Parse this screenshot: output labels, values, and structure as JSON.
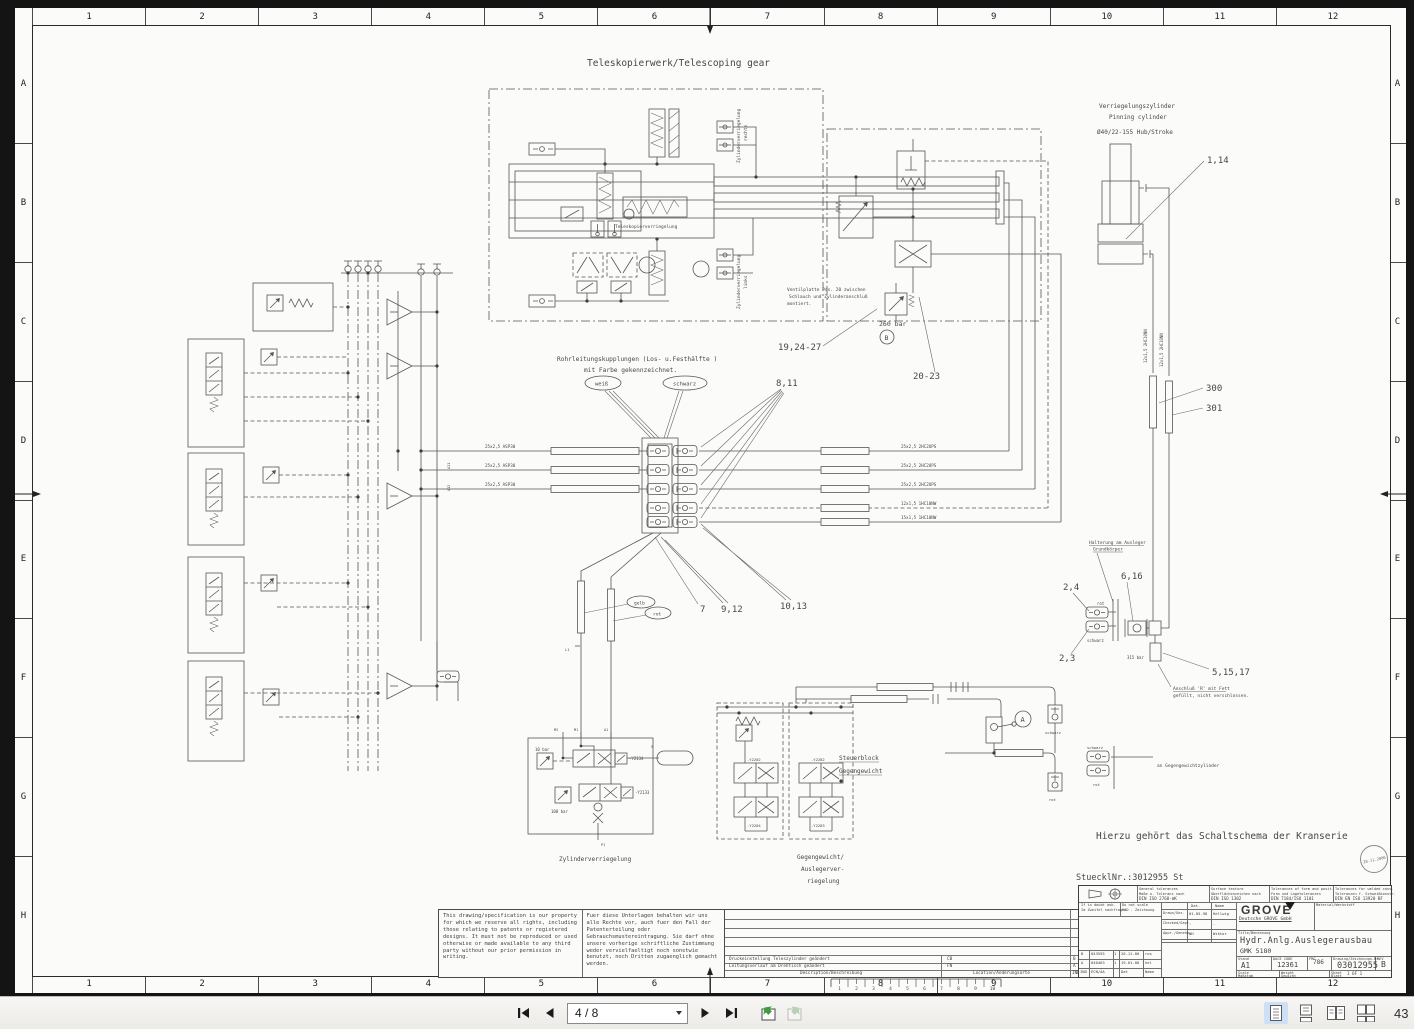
{
  "viewer": {
    "toolbar": {
      "page_field": "4 / 8",
      "zoom_value": "43",
      "icon_names": [
        "first-page",
        "previous-page",
        "next-page",
        "last-page",
        "previous-view",
        "next-view",
        "single-page-layout",
        "continuous-layout",
        "facing-layout",
        "facing-continuous-layout"
      ]
    },
    "rulers": {
      "cols": [
        "1",
        "2",
        "3",
        "4",
        "5",
        "6",
        "7",
        "8",
        "9",
        "10",
        "11",
        "12"
      ],
      "rows": [
        "A",
        "B",
        "C",
        "D",
        "E",
        "F",
        "G",
        "H"
      ]
    }
  },
  "drawing": {
    "title": "Teleskopierwerk/Telescoping gear",
    "pinning_l1": "Verriegelungszylinder",
    "pinning_l2": "Pinning cylinder",
    "pinning_l3": "Ø40/22-155 Hub/Stroke",
    "callout_1_14": "1,14",
    "ventilplatte_l1": "Ventilplatte Pos. 20 zwischen",
    "ventilplatte_l2": "Schlauch und Zylinderanschluß",
    "ventilplatte_l3": "montiert.",
    "bar_260": "260 bar",
    "stamp_b": "B",
    "stamp_a": "A",
    "callout_19_24_27": "19,24-27",
    "callout_20_23": "20-23",
    "rohr_l1": "Rohrleitungskupplungen (Los- u.Festhälfte )",
    "rohr_l2": "mit Farbe gekennzeichnet.",
    "tag_weiss": "weiß",
    "tag_schwarz": "schwarz",
    "tag_gelb": "gelb",
    "tag_rot": "rot",
    "callout_8_11": "8,11",
    "callout_7": "7",
    "callout_9_12": "9,12",
    "callout_10_13": "10,13",
    "callout_300": "300",
    "callout_301": "301",
    "callout_2_4": "2,4",
    "callout_2_3": "2,3",
    "callout_6_16": "6,16",
    "callout_5_15_17": "5,15,17",
    "pipe_asp30": "25x2,5 ASP30",
    "pipe_2hc2ops": "25x2,5 2HC2OPS",
    "pipe_12_1hc10nw": "12x1,5 1HC10NW",
    "pipe_15_1hc10nw": "15x1,5 1HC10NW",
    "pipe_2hc10nn": "12x1,5 2HC10NN",
    "halterung_l1": "Halterung am Ausleger",
    "halterung_l2": "Grundkörper",
    "bar_315": "315 bar",
    "anschluss_l1": "Anschluß 'R' mit Fett",
    "anschluss_l2": "gefüllt, nicht verschlossen.",
    "steuerblock_l1": "Steuerblock",
    "steuerblock_l2": "Gegengewicht",
    "gg_zyl": "an Gegengewichtzylinder",
    "zyl_verriegelung": "Zylinderverriegelung",
    "zyl_rechts": "rechts",
    "zyl_links": "links",
    "telesk_verr": "Teleskopierverriegelung",
    "gg_l1": "Gegengewicht/",
    "gg_l2": "Auslegerver-",
    "gg_l3": "riegelung",
    "hierzu": "Hierzu gehört das Schaltschema der Kranserie",
    "stueckliste": "StuecklNr.:3012955 St",
    "bar_10": "10 bar",
    "bar_100": "100 bar",
    "y2134": "-Y2134",
    "y2133": "-Y2133",
    "y2202": "-Y2202",
    "y2204": "-Y2204",
    "y2282": "-Y2282",
    "y2283": "-Y2283",
    "port_m2": "M2",
    "port_m1": "M1",
    "port_a1": "A1",
    "port_p1": "P1",
    "port_s": "S",
    "port_l1": "L1",
    "port_a11": "A11",
    "port_a12": "A12",
    "scale_ruler": [
      "1",
      "2",
      "3",
      "4",
      "5",
      "6",
      "7",
      "8",
      "9",
      "10"
    ]
  },
  "title_block": {
    "stamp_date": "28.11.2000",
    "general_en": "General tolerances",
    "general_de": "Maße o. Toleranz nach",
    "general_din": "DIN ISO 2768-mK",
    "surface_en": "Surface texture",
    "surface_de": "Oberflächenzeichen nach",
    "surface_din": "DIN ISO 1302",
    "form_en": "Tolerances of form and posit.",
    "form_de": "Form und Lagetoleranzen",
    "form_din": "DIN 7184/ISO 1101",
    "weld_en": "Tolerances for welded cons.",
    "weld_de": "Toleranzen f. Schweißkonstr.",
    "weld_din": "DIN EN ISO 13920 BF",
    "doubt_en": "If in doubt ask.",
    "doubt_de": "Im Zweifel nachfragen",
    "noscale_en": "Do not scale",
    "noscale_de": "CAD - Zeichnung",
    "col_dat": "Dat.",
    "col_name": "Name",
    "row_drawn": "Drawn/Gez.",
    "drawn_date": "01.05.98",
    "drawn_name": "Hellwig",
    "row_checked": "Checked/Gepr.",
    "checked_date": "-",
    "checked_name": "-",
    "row_approved": "Appr./Genehm.",
    "approved_date": "NH",
    "approved_name": "Wiktor",
    "grove": "GROVE",
    "grove_sub": "Deutsche GROVE GmbH",
    "material": "Material/Werkstoff",
    "title_label": "Title/Benennung",
    "title_main": "Hydr.Anlg.Auslegerausbau",
    "title_sub": "GMK 5180",
    "stand_label": "Stand",
    "stand_value": "A1",
    "dace_label": "DACE CODE",
    "dace_value": "12361",
    "fmc_label": "FMC",
    "fmc_value": "786",
    "drawing_label": "Drawing/Zeichnungs-Nr.",
    "drawing_no": "03012955",
    "rev_label": "REV",
    "rev_value": "B",
    "scale_en": "Scale",
    "scale_de": "Maßstab",
    "weight_en": "Weight",
    "weight_de": "Gewicht",
    "sheet_en": "Sheet",
    "sheet_value": "1 OF 1",
    "sheet_de": "Blatt",
    "mini": [
      [
        "B",
        "043555",
        "1",
        "26-11-00",
        "ros"
      ],
      [
        "A",
        "040463",
        "1",
        "19-01-00",
        "hel"
      ],
      [
        "IND",
        "ECN/ÄA",
        "",
        "Dat",
        "Name"
      ]
    ]
  },
  "disclaimer": {
    "en": "This drawing/specification is our property for which we reserve all rights, including those relating to patents or registered designs. It must not be reproduced or used otherwise or made available to any third party without our prior permission in writing.",
    "de": "Fuer diese Unterlagen behalten wir uns alle Rechte vor, auch fuer den Fall der Patenterteilung oder Gebrauchsmustereintragung. Sie darf ohne unsere vorherige schriftliche Zustimmung weder vervielfaeltigt noch sonstwie benutzt, noch Dritten zugaenglich gemacht werden."
  },
  "revisions": {
    "header_desc": "Description/Beschreibung",
    "header_loc": "Location/Änderungsorte",
    "header_ind": "IND",
    "rows": [
      {
        "desc": "Druckeinstellung Teleszylinder geändert",
        "loc": "CB",
        "ind": "B"
      },
      {
        "desc": "Leitungsverlauf am Drehtisch geändert",
        "loc": "FN",
        "ind": "A"
      }
    ]
  }
}
